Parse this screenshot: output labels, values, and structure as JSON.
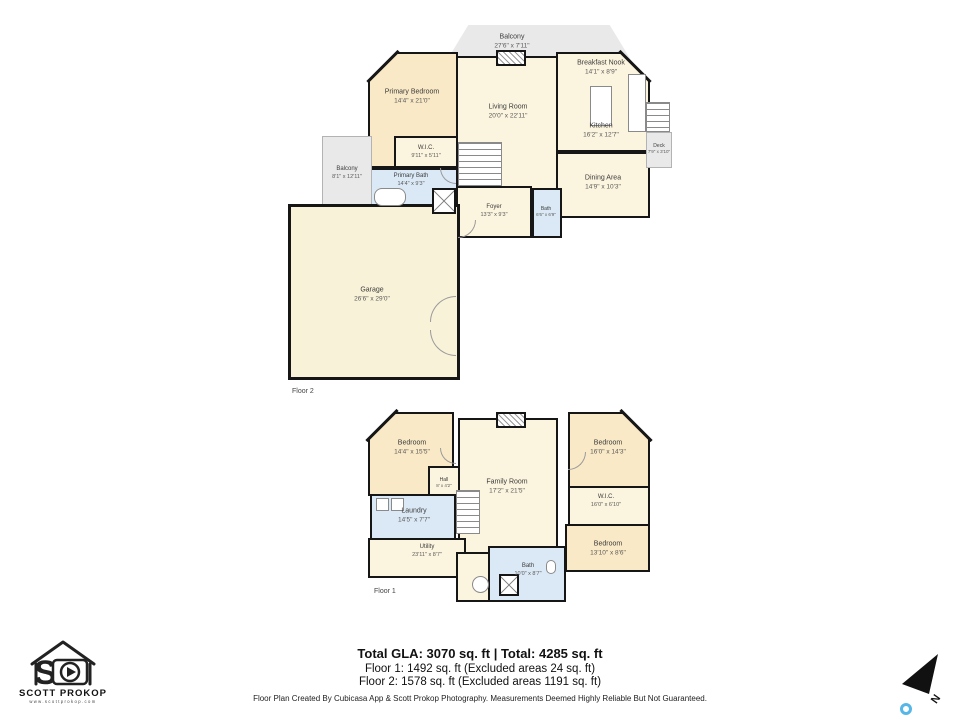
{
  "branding": {
    "name": "SCOTT PROKOP",
    "url": "www.scottprokop.com"
  },
  "compass": {
    "label": "N"
  },
  "summary": {
    "total_line": "Total GLA: 3070 sq. ft | Total: 4285 sq. ft",
    "floor1_line": "Floor 1: 1492 sq. ft (Excluded areas 24 sq. ft)",
    "floor2_line": "Floor 2: 1578 sq. ft (Excluded areas 1191 sq. ft)",
    "disclaimer": "Floor Plan Created By Cubicasa App & Scott Prokop Photography. Measurements Deemed Highly Reliable But Not Guaranteed."
  },
  "colors": {
    "wall": "#161616",
    "room_cream": "#fbf4de",
    "room_tan": "#f9e9c6",
    "room_blue": "#dbe9f6",
    "outdoor_gray": "#e9e9e9",
    "garage_yellow": "#f8f2d8",
    "pin_blue": "#57b6e8"
  },
  "floor2": {
    "label": "Floor 2",
    "rooms": {
      "balcony_top": {
        "name": "Balcony",
        "dims": "27'6\" x 7'11\""
      },
      "primary_bedroom": {
        "name": "Primary Bedroom",
        "dims": "14'4\" x 21'0\""
      },
      "living_room": {
        "name": "Living Room",
        "dims": "20'0\" x 22'11\""
      },
      "breakfast_nook": {
        "name": "Breakfast Nook",
        "dims": "14'1\" x 8'9\""
      },
      "kitchen": {
        "name": "Kitchen",
        "dims": "16'2\" x 12'7\""
      },
      "deck": {
        "name": "Deck",
        "dims": "7'9\" x 3'10\""
      },
      "dining_area": {
        "name": "Dining Area",
        "dims": "14'9\" x 10'3\""
      },
      "wic": {
        "name": "W.I.C.",
        "dims": "9'11\" x 5'11\""
      },
      "primary_bath": {
        "name": "Primary Bath",
        "dims": "14'4\" x 9'3\""
      },
      "balcony_left": {
        "name": "Balcony",
        "dims": "8'1\" x 12'11\""
      },
      "foyer": {
        "name": "Foyer",
        "dims": "13'3\" x 9'3\""
      },
      "bath": {
        "name": "Bath",
        "dims": "6'6\" x 6'9\""
      },
      "garage": {
        "name": "Garage",
        "dims": "26'6\" x 29'0\""
      }
    }
  },
  "floor1": {
    "label": "Floor 1",
    "rooms": {
      "bedroom_left": {
        "name": "Bedroom",
        "dims": "14'4\" x 15'5\""
      },
      "family_room": {
        "name": "Family Room",
        "dims": "17'2\" x 21'5\""
      },
      "bedroom_right": {
        "name": "Bedroom",
        "dims": "16'0\" x 14'3\""
      },
      "hall": {
        "name": "Hall",
        "dims": "8' x 4'2\""
      },
      "laundry": {
        "name": "Laundry",
        "dims": "14'5\" x 7'7\""
      },
      "wic": {
        "name": "W.I.C.",
        "dims": "16'0\" x 6'10\""
      },
      "utility": {
        "name": "Utility",
        "dims": "23'11\" x 8'7\""
      },
      "bedroom_bottom": {
        "name": "Bedroom",
        "dims": "13'10\" x 8'6\""
      },
      "bath": {
        "name": "Bath",
        "dims": "10'0\" x 8'7\""
      }
    }
  }
}
